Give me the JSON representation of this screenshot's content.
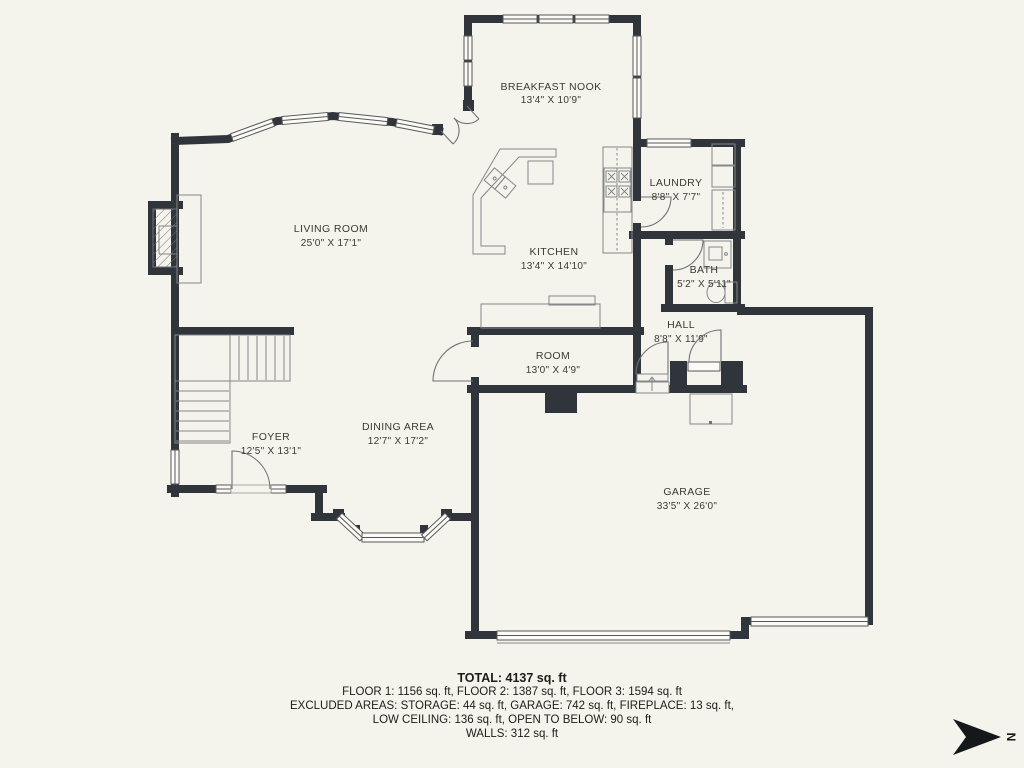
{
  "floorplan": {
    "rooms": [
      {
        "name": "BREAKFAST NOOK",
        "dims": "13'4\" X 10'9\""
      },
      {
        "name": "LIVING ROOM",
        "dims": "25'0\" X 17'1\""
      },
      {
        "name": "KITCHEN",
        "dims": "13'4\" X 14'10\""
      },
      {
        "name": "LAUNDRY",
        "dims": "8'8\" X 7'7\""
      },
      {
        "name": "BATH",
        "dims": "5'2\" X 5'11\""
      },
      {
        "name": "HALL",
        "dims": "8'8\" X 11'9\""
      },
      {
        "name": "ROOM",
        "dims": "13'0\" X 4'9\""
      },
      {
        "name": "FOYER",
        "dims": "12'5\" X 13'1\""
      },
      {
        "name": "DINING AREA",
        "dims": "12'7\" X 17'2\""
      },
      {
        "name": "GARAGE",
        "dims": "33'5\" X 26'0\""
      }
    ]
  },
  "summary": {
    "total": "TOTAL: 4137 sq. ft",
    "floors": "FLOOR 1: 1156 sq. ft, FLOOR 2: 1387 sq. ft, FLOOR 3: 1594 sq. ft",
    "excluded1": "EXCLUDED AREAS: STORAGE: 44 sq. ft, GARAGE: 742 sq. ft, FIREPLACE: 13 sq. ft,",
    "excluded2": "LOW CEILING: 136 sq. ft, OPEN TO BELOW: 90 sq. ft",
    "walls": "WALLS: 312 sq. ft"
  },
  "compass": {
    "label": "N"
  },
  "colors": {
    "background": "#f5f4ec",
    "wall": "#2f353a",
    "fixture": "#85878a",
    "text": "#3a3a35"
  }
}
